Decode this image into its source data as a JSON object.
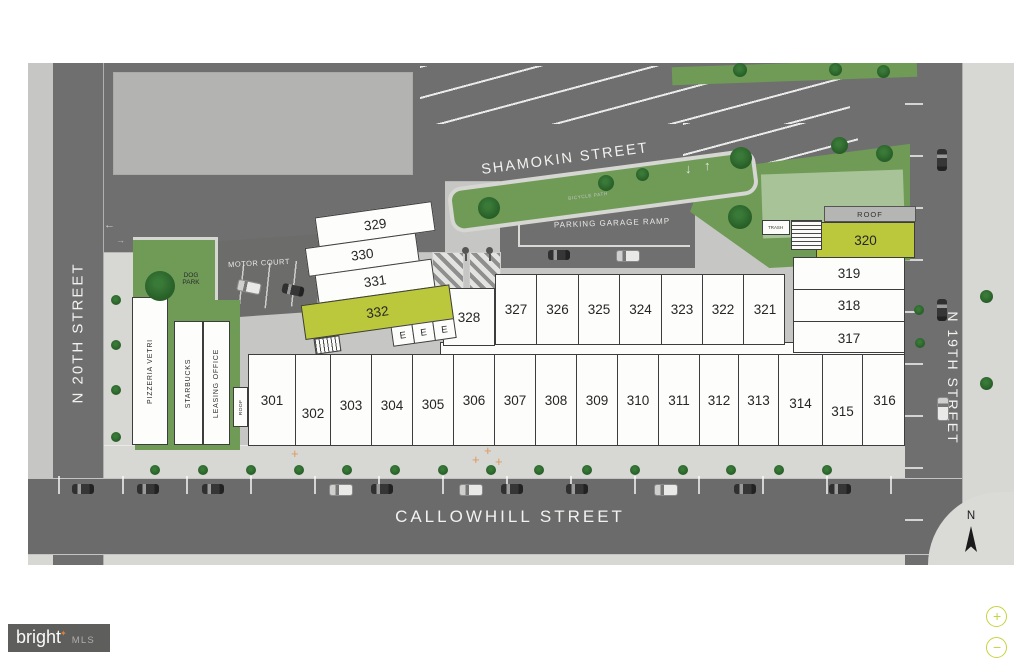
{
  "plan": {
    "streets": {
      "shamokin": "SHAMOKIN STREET",
      "callowhill": "CALLOWHILL STREET",
      "n20th": "N 20TH STREET",
      "n19th": "N 19TH STREET"
    },
    "labels": {
      "parking_garage_ramp": "PARKING GARAGE RAMP",
      "bicycle_path": "BICYCLE PATH",
      "motor_court": "MOTOR COURT",
      "dog_park_line1": "DOG",
      "dog_park_line2": "PARK",
      "trash": "TRASH",
      "roof_upper": "ROOF",
      "roof_lower": "ROOF"
    },
    "tenants": {
      "pizzeria": "PIZZERIA VETRI",
      "starbucks": "STARBUCKS",
      "leasing": "LEASING OFFICE"
    },
    "units": {
      "angled": [
        "329",
        "330",
        "331",
        "332"
      ],
      "elevators": [
        "E",
        "E",
        "E"
      ],
      "u328": "328",
      "middle_row": [
        "327",
        "326",
        "325",
        "324",
        "323",
        "322",
        "321"
      ],
      "right_highlight": "320",
      "right_column": [
        "319",
        "318",
        "317"
      ],
      "bottom_row": [
        "301",
        "302",
        "303",
        "304",
        "305",
        "306",
        "307",
        "308",
        "309",
        "310",
        "311",
        "312",
        "313",
        "314",
        "315",
        "316"
      ]
    },
    "symbols": {
      "arrow_down": "↓",
      "arrow_up": "↑",
      "arrow_left": "←",
      "arrow_right": "→",
      "plus_marker": "+"
    },
    "highlight_color": "#bcc83c"
  },
  "compass": {
    "label": "N"
  },
  "watermark": {
    "brand": "bright",
    "star": "✦",
    "suffix": "MLS"
  },
  "controls": {
    "zoom_in": "+",
    "zoom_out": "−"
  }
}
